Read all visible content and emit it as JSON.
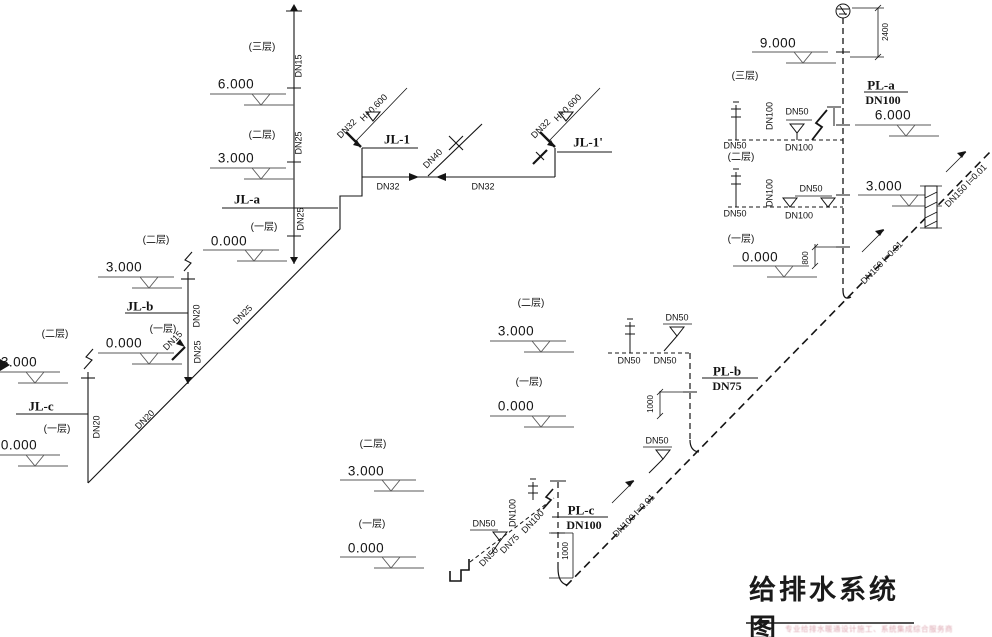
{
  "title": "给排水系统图",
  "watermark": "专业给排水暖通设计施工、系统集成综合服务商",
  "colors": {
    "line": "#141414",
    "bg": "#ffffff",
    "watermark": "#cd7d8c"
  },
  "supply": {
    "jl1": {
      "floor3": "(三层)",
      "dn15": "DN15",
      "elev6": "6.000",
      "floor2": "(二层)",
      "dn25_mid": "DN25",
      "elev3": "3.000",
      "jla_name": "JL-a",
      "dn25_low": "DN25",
      "floor1": "(一层)",
      "elev0": "0.000"
    },
    "main": {
      "jl1_name": "JL-1",
      "jl1p_name": "JL-1'",
      "dn32_stub_left": "DN32",
      "dn32_stub_right": "DN32",
      "h_elev_left": "H+0.600",
      "h_elev_right": "H+0.600",
      "dn40": "DN40",
      "dn32_run_left": "DN32",
      "dn32_run_right": "DN32"
    },
    "jlb": {
      "floor2": "(二层)",
      "elev3": "3.000",
      "name": "JL-b",
      "floor1": "(一层)",
      "elev0": "0.000",
      "dn15_stub": "DN15",
      "dn20_riser": "DN20",
      "dn25_riser": "DN25",
      "dn25_diag": "DN25"
    },
    "jlc": {
      "floor2": "(二层)",
      "elev3": "3.000",
      "name": "JL-c",
      "floor1": "(一层)",
      "elev0": "0.000",
      "dn20_riser": "DN20",
      "dn20_diag": "DN20"
    }
  },
  "drain": {
    "pla": {
      "elev9": "9.000",
      "dim2400": "2400",
      "floor3": "(三层)",
      "name": "PL-a",
      "size": "DN100",
      "elev6": "6.000",
      "floor2": "(二层)",
      "floor1": "(一层)",
      "elev0": "0.000",
      "dim800": "800",
      "branch2": {
        "dn100_riser": "DN100",
        "dn50_drain": "DN50",
        "dn50_left": "DN50",
        "dn100_run": "DN100"
      },
      "branch1": {
        "dn100_riser": "DN100",
        "dn50_drains": "DN50",
        "dn50_left": "DN50",
        "dn100_run": "DN100"
      }
    },
    "main": {
      "dn150_lower": "DN150 I=0.01",
      "dn150_upper": "DN150 I=0.01",
      "dn100_slope": "DN100 I=0.01",
      "elev3_right": "3.000"
    },
    "plb": {
      "floor2": "(二层)",
      "elev3": "3.000",
      "dn50_drain": "DN50",
      "dn50_run_left": "DN50",
      "dn50_run_right": "DN50",
      "name": "PL-b",
      "size": "DN75",
      "floor1": "(一层)",
      "elev0": "0.000",
      "dim1000": "1000",
      "dn50_mid": "DN50"
    },
    "plc": {
      "floor2": "(二层)",
      "elev3": "3.000",
      "floor1": "(一层)",
      "elev0": "0.000",
      "dn50_drain": "DN50",
      "dn50_diag": "DN50",
      "dn75_diag": "DN75",
      "dn100_diag": "DN100",
      "dn100_riser": "DN100",
      "name": "PL-c",
      "size": "DN100",
      "dim1000": "1000"
    }
  }
}
